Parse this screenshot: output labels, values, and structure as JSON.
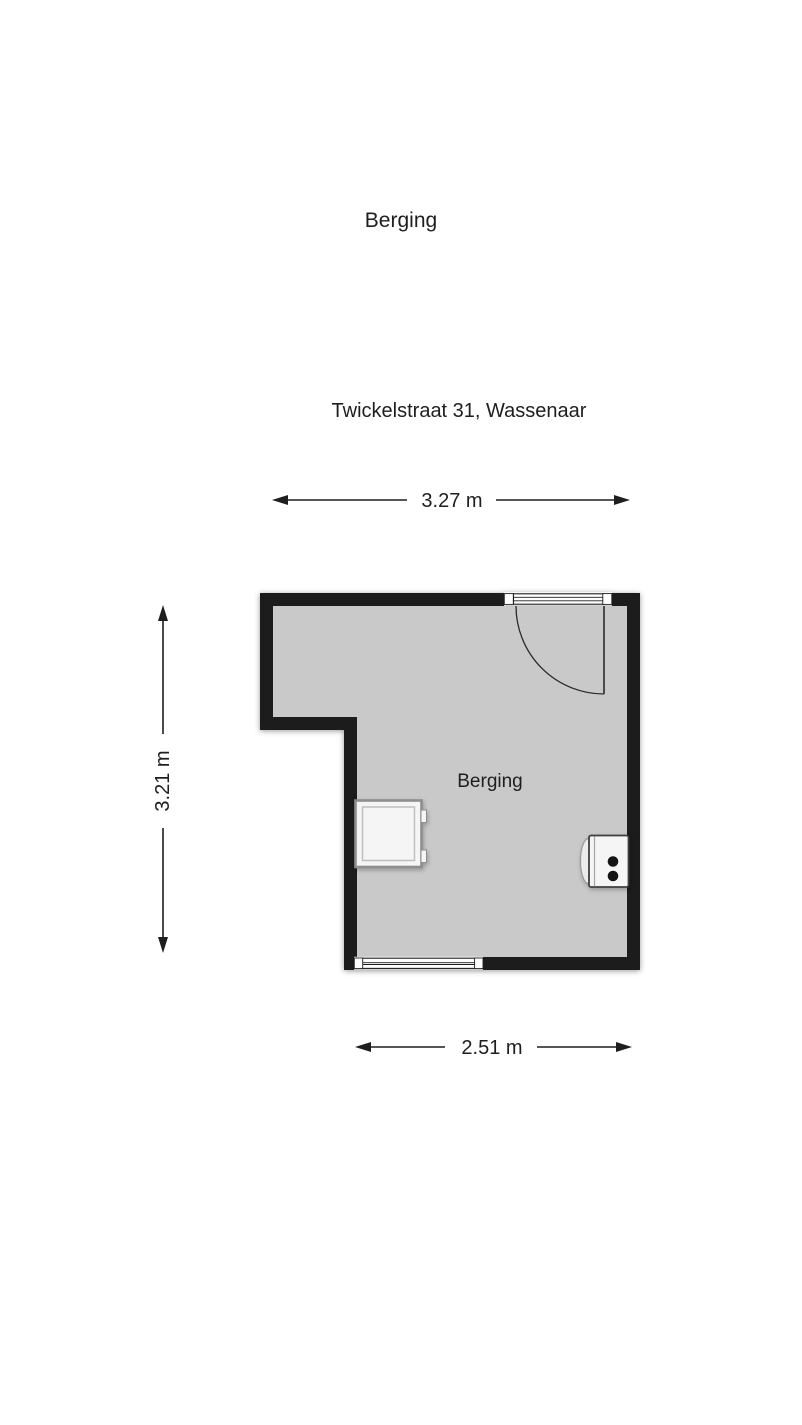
{
  "header": {
    "title": "Berging",
    "address": "Twickelstraat 31, Wassenaar"
  },
  "floor_plan": {
    "room_label": "Berging",
    "dimensions": {
      "width_top": "3.27 m",
      "height_left": "3.21 m",
      "width_bottom": "2.51 m"
    },
    "colors": {
      "wall": "#1c1c1c",
      "floor": "#c9c9c9",
      "background": "#ffffff",
      "text": "#1e1e1e",
      "fixture_fill": "#f5f5f5",
      "fixture_stroke": "#8e8e8e"
    },
    "openings": [
      {
        "name": "door-top-right",
        "symbol": "quarter-circle swing arc with glazed threshold"
      },
      {
        "name": "window-bottom",
        "symbol": "double-line window"
      }
    ],
    "fixtures": [
      {
        "name": "washing-machine",
        "location": "left wall"
      },
      {
        "name": "boiler",
        "location": "right wall"
      }
    ]
  }
}
